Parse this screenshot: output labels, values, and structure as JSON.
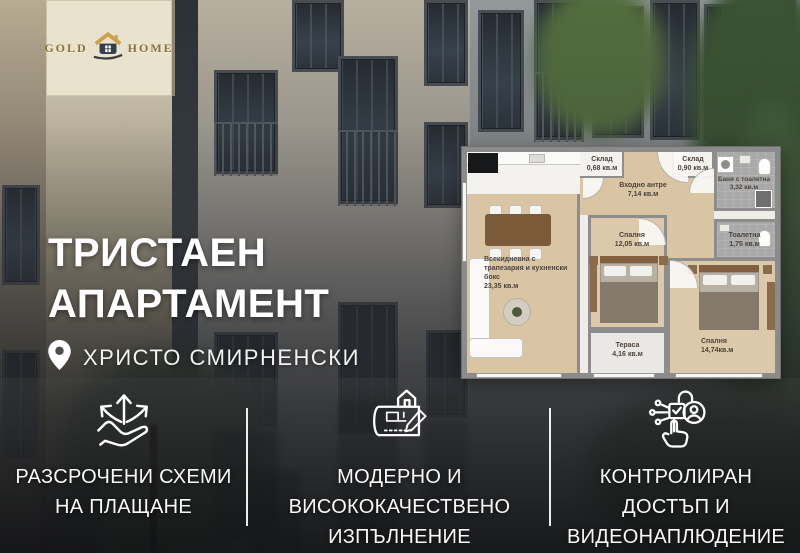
{
  "brand": {
    "word1": "GOLD",
    "word2": "HOME",
    "icon": "gold-home-house-icon"
  },
  "hero": {
    "title_line1": "ТРИСТАЕН",
    "title_line2": "АПАРТАМЕНТ",
    "location_icon": "location-pin-icon",
    "location": "ХРИСТО СМИРНЕНСКИ"
  },
  "floor_plan": {
    "rooms": [
      {
        "name": "Всекидневна с трапезария и кухненски бокс",
        "area": "23,35 кв.м"
      },
      {
        "name": "Склад",
        "area": "0,68 кв.м"
      },
      {
        "name": "Входно антре",
        "area": "7,14 кв.м"
      },
      {
        "name": "Склад",
        "area": "0,90 кв.м"
      },
      {
        "name": "Баня с тоалетна",
        "area": "3,32 кв.м"
      },
      {
        "name": "Тоалетна",
        "area": "1,75 кв.м"
      },
      {
        "name": "Спалня",
        "area": "12,05 кв.м"
      },
      {
        "name": "Тераса",
        "area": "4,16 кв.м"
      },
      {
        "name": "Спалня",
        "area": "14,74кв.м"
      }
    ]
  },
  "features": [
    {
      "icon": "hand-arrows-icon",
      "lines": [
        "РАЗСРОЧЕНИ СХЕМИ",
        "НА ПЛАЩАНЕ"
      ]
    },
    {
      "icon": "blueprint-pencil-icon",
      "lines": [
        "МОДЕРНО И",
        "ВИСОКОКАЧЕСТВЕНО",
        "ИЗПЪЛНЕНИЕ"
      ]
    },
    {
      "icon": "access-control-icon",
      "lines": [
        "КОНТРОЛИРАН",
        "ДОСТЪП И",
        "ВИДЕОНАПЛЮДЕНИЕ"
      ]
    }
  ],
  "colors": {
    "brand_gold": "#8d713c",
    "roof_gold": "#c9a24b",
    "wood_floor": "#d9c4a4",
    "wall_gray": "#8d8d8d",
    "overlay_dark": "#141517",
    "text_white": "#ffffff"
  }
}
